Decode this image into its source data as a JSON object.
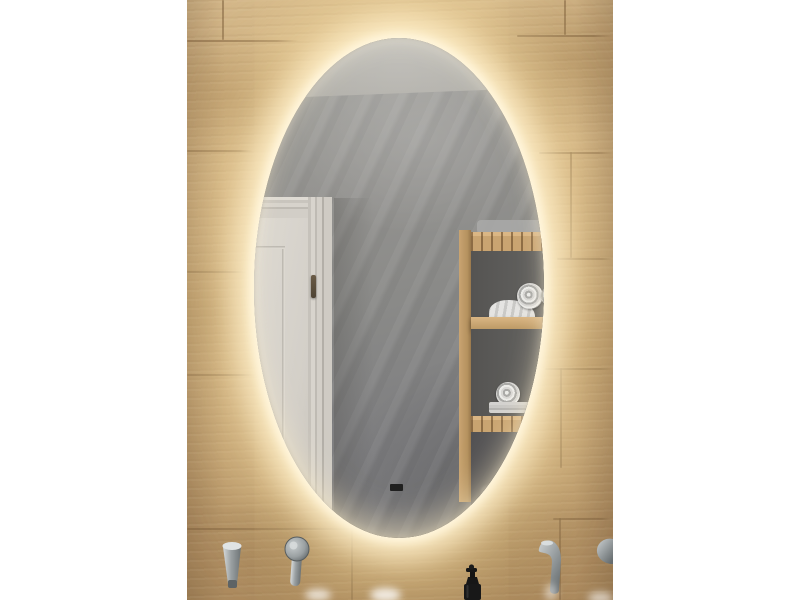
{
  "meta": {
    "type": "product-photo",
    "description": "Bathroom product photo of a capsule-shaped mirror with warm LED backlight mounted on a wood-plank tile wall; the mirror reflects a grey plaster wall, a white panelled door with a dark handle, and a light-wood shelf tower holding rolled and folded towels; below are wall-mounted chrome faucets, a round mixer handle and a black soap-dispenser pump; the photo is letterboxed with white bars on both sides."
  },
  "scene": {
    "objects": [
      {
        "name": "wood-tile-wall",
        "description": "oak-look plank tiles with staggered seams"
      },
      {
        "name": "oval-mirror",
        "description": "vertical capsule mirror with warm LED halo"
      },
      {
        "name": "reflected-ceiling",
        "description": "light grey ceiling strip at top of reflection"
      },
      {
        "name": "reflected-door",
        "description": "white panelled door with architrave and dark brass handle"
      },
      {
        "name": "reflected-shelf-tower",
        "description": "light wooden slatted tower with towels on shelves"
      },
      {
        "name": "left-faucet-spout",
        "description": "wall-mounted chrome spout"
      },
      {
        "name": "left-faucet-handle",
        "description": "round chrome mixer handle with lever"
      },
      {
        "name": "right-faucet-spout",
        "description": "wall-mounted chrome spout with water glint"
      },
      {
        "name": "edge-faucet",
        "description": "partial chrome fixture cut by photo edge"
      },
      {
        "name": "soap-dispenser",
        "description": "black pump bottle"
      },
      {
        "name": "basin-highlights",
        "description": "blurred white glints of the basin at bottom edge"
      }
    ]
  },
  "palette": {
    "canvas_bg": "#ffffff",
    "wood_base": "#c3a377",
    "wood_light": "#d2b689",
    "wood_dark": "#a9885d",
    "seam_line": "rgba(122,92,58,0.55)",
    "glow_core": "#fff6dd",
    "glow_warm": "#fbe4ab",
    "wall_light": "#a3a29d",
    "wall_dark": "#737376",
    "ceiling": "#bdbbb5",
    "door_face": "#d8d4cd",
    "door_trim": "#bfbbb4",
    "door_handle": "#6a5b46",
    "shelf_wood": "#c9a471",
    "shelf_wood_light": "#dab684",
    "shelf_dark": "#676664",
    "shelf_shadow": "#99784c",
    "towel_white": "#e5e4e2",
    "towel_gray": "#a9a9a7",
    "chrome_light": "#d6dadb",
    "chrome_mid": "#9aa0a2",
    "chrome_dark": "#6e7476",
    "soap_black": "#181818"
  },
  "geometry": {
    "photo": {
      "left": 187,
      "top": 0,
      "width": 426,
      "height": 600
    },
    "mirror": {
      "left": 67,
      "top": 38,
      "width": 290,
      "height": 500
    }
  },
  "wall_tiles": {
    "horizontal_seams": [
      {
        "y": 40,
        "x": 0,
        "len": 112
      },
      {
        "y": 35,
        "x": 330,
        "len": 96
      },
      {
        "y": 150,
        "x": 0,
        "len": 66
      },
      {
        "y": 152,
        "x": 352,
        "len": 74
      },
      {
        "y": 271,
        "x": 0,
        "len": 60
      },
      {
        "y": 258,
        "x": 370,
        "len": 56
      },
      {
        "y": 374,
        "x": 0,
        "len": 70
      },
      {
        "y": 368,
        "x": 358,
        "len": 68
      },
      {
        "y": 528,
        "x": 0,
        "len": 300
      },
      {
        "y": 518,
        "x": 366,
        "len": 60
      }
    ],
    "vertical_seams": [
      {
        "x": 35,
        "y": 0,
        "len": 40
      },
      {
        "x": 377,
        "y": 0,
        "len": 35
      },
      {
        "x": 383,
        "y": 152,
        "len": 106
      },
      {
        "x": 373,
        "y": 368,
        "len": 100
      },
      {
        "x": 164,
        "y": 528,
        "len": 72
      },
      {
        "x": 372,
        "y": 518,
        "len": 82
      }
    ]
  },
  "basin_highlights": [
    {
      "x": 118,
      "y": 589,
      "w": 26,
      "h": 12,
      "opacity": 0.7
    },
    {
      "x": 183,
      "y": 588,
      "w": 31,
      "h": 14,
      "opacity": 0.8
    },
    {
      "x": 358,
      "y": 584,
      "w": 12,
      "h": 17,
      "opacity": 0.5
    },
    {
      "x": 401,
      "y": 592,
      "w": 25,
      "h": 12,
      "opacity": 0.6
    }
  ]
}
